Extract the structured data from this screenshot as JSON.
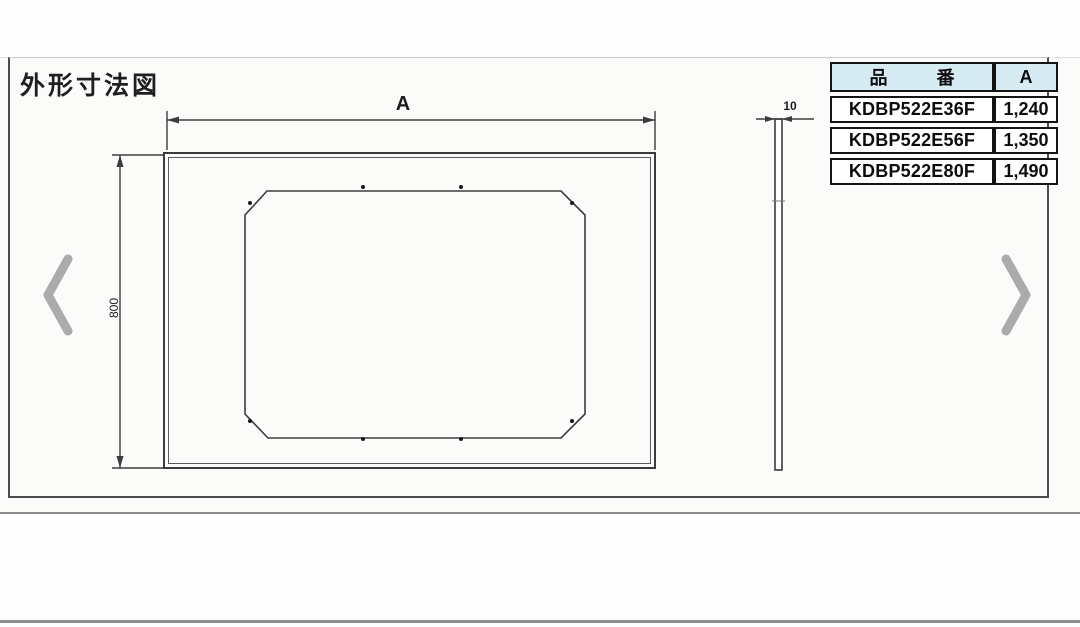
{
  "page": {
    "title": "外形寸法図"
  },
  "carousel": {
    "prev_icon": "chevron-left-icon",
    "next_icon": "chevron-right-icon"
  },
  "drawing": {
    "front_view": {
      "width_dim_label": "A",
      "height_dim_label": "800"
    },
    "side_view": {
      "thickness_dim_label": "10"
    }
  },
  "spec_table": {
    "headers": {
      "part_no": "品 番",
      "dim_a": "A"
    },
    "rows": [
      {
        "part_no": "KDBP522E36F",
        "dim_a": "1,240"
      },
      {
        "part_no": "KDBP522E56F",
        "dim_a": "1,350"
      },
      {
        "part_no": "KDBP522E80F",
        "dim_a": "1,490"
      }
    ]
  },
  "colors": {
    "line": "#3c3c3c",
    "chevron": "#ababab",
    "table_header_bg": "#d7ebf3"
  }
}
